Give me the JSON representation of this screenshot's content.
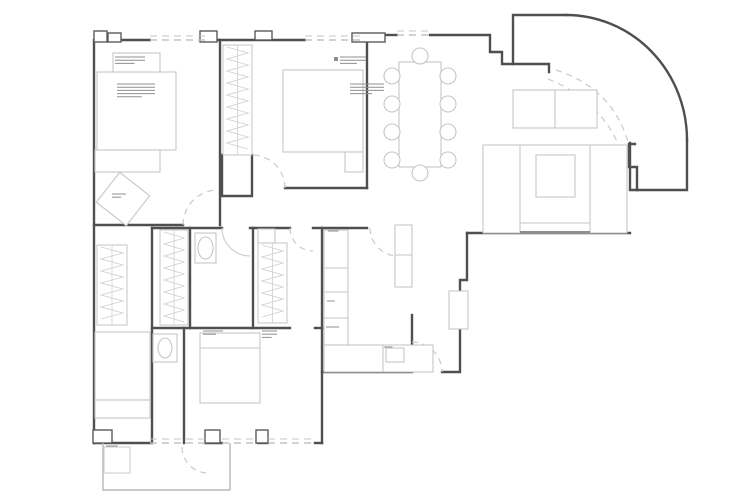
{
  "document": {
    "kind": "architectural-floor-plan",
    "canvas": {
      "width": 750,
      "height": 500
    }
  },
  "colors": {
    "background": "#ffffff",
    "wall": "#4f4f4f",
    "pier": "#5a5a5a",
    "furniture": "#c6c6c6",
    "furniture_dark": "#8e8e8e",
    "window_dash": "#c4c4c4",
    "door_dash": "#c9c9c9",
    "door_solid": "#d2d2d2",
    "zigzag": "#d0d0d0",
    "note": "#8f8f8f",
    "terrace": "#b8b8b8"
  },
  "plan": {
    "walls": [
      {
        "name": "wall-left-exterior",
        "d": "M94,443 L94,40 L150,40"
      },
      {
        "name": "wall-top-bedroom1",
        "d": "M207,40 L305,40"
      },
      {
        "name": "wall-top-bedroom2",
        "d": "M362,40 L367,40 L367,188"
      },
      {
        "name": "wall-bedroom2-bottom",
        "d": "M285,188 L367,188"
      },
      {
        "name": "wall-partition-b1-b2",
        "d": "M220,40 L220,225"
      },
      {
        "name": "wall-bedroom1-bottom",
        "d": "M94,225 L183,225"
      },
      {
        "name": "wall-closet-niche",
        "d": "M222,155 L222,196 L252,196 L252,155"
      },
      {
        "name": "wall-corridor-band-1",
        "d": "M152,228 L222,228"
      },
      {
        "name": "wall-corridor-band-2",
        "d": "M250,228 L290,228"
      },
      {
        "name": "wall-corridor-band-3",
        "d": "M313,228 L367,228"
      },
      {
        "name": "wall-bedroomBL-right",
        "d": "M152,228 L152,443"
      },
      {
        "name": "wall-closet-bath-divider",
        "d": "M190,228 L190,328"
      },
      {
        "name": "wall-bath2-right",
        "d": "M253,228 L253,328"
      },
      {
        "name": "wall-bath1-bedroom3",
        "d": "M184,328 L184,443"
      },
      {
        "name": "wall-midband-bottom",
        "d": "M152,328 L290,328"
      },
      {
        "name": "wall-midband-bottom-2",
        "d": "M315,328 L322,328"
      },
      {
        "name": "wall-kitchen-left",
        "d": "M322,228 L322,443"
      },
      {
        "name": "wall-kitchen-bottom",
        "d": "M322,372 L410,372"
      },
      {
        "name": "wall-kitchen-door-jamb",
        "d": "M412,315 L412,372"
      },
      {
        "name": "wall-hall-entry",
        "d": "M442,372 L460,372 L460,280 L467,280 L467,233"
      },
      {
        "name": "wall-living-bottom",
        "d": "M467,233 L630,233"
      },
      {
        "name": "wall-living-right",
        "d": "M630,143 L630,190 L637,190"
      },
      {
        "name": "wall-balcony-bottom",
        "d": "M637,190 L687,190 L687,140"
      },
      {
        "name": "wall-balcony-notch",
        "d": "M637,190 L637,167 L629,167 L629,144 L635,144"
      },
      {
        "name": "wall-dining-top-1",
        "d": "M385,35 L397,35"
      },
      {
        "name": "wall-dining-top-2",
        "d": "M430,35 L490,35 L490,52 L502,52 L502,64 L513,64 L513,15 L566,15"
      },
      {
        "name": "wall-balcony-curve",
        "d": "M566,15 A121,125 0 0 1 687,140"
      },
      {
        "name": "wall-balcony-inner",
        "d": "M513,64 L549,64 L549,72"
      },
      {
        "name": "wall-bottom-1",
        "d": "M94,443 L150,443"
      },
      {
        "name": "wall-bottom-2",
        "d": "M205,443 L222,443"
      },
      {
        "name": "wall-bottom-3",
        "d": "M258,443 L268,443"
      },
      {
        "name": "wall-bottom-4",
        "d": "M315,443 L322,443"
      }
    ],
    "piers": [
      {
        "name": "pier-top-corner",
        "x": 94,
        "y": 31,
        "w": 13,
        "h": 11
      },
      {
        "name": "pier-top-a",
        "x": 108,
        "y": 33,
        "w": 13,
        "h": 9
      },
      {
        "name": "pier-top-b",
        "x": 200,
        "y": 31,
        "w": 17,
        "h": 11
      },
      {
        "name": "pier-top-c",
        "x": 255,
        "y": 31,
        "w": 17,
        "h": 9
      },
      {
        "name": "pier-dining",
        "x": 352,
        "y": 33,
        "w": 33,
        "h": 9
      },
      {
        "name": "pier-bottom-a",
        "x": 93,
        "y": 430,
        "w": 19,
        "h": 13
      },
      {
        "name": "pier-bottom-b",
        "x": 205,
        "y": 430,
        "w": 15,
        "h": 13
      },
      {
        "name": "pier-bottom-c",
        "x": 256,
        "y": 430,
        "w": 12,
        "h": 13
      }
    ],
    "windows": [
      {
        "name": "window-bedroom1-top",
        "x1": 150,
        "y1": 40,
        "x2": 207,
        "y2": 40
      },
      {
        "name": "window-bedroom2-top",
        "x1": 305,
        "y1": 40,
        "x2": 362,
        "y2": 40
      },
      {
        "name": "window-dining-top",
        "x1": 397,
        "y1": 35,
        "x2": 430,
        "y2": 35
      },
      {
        "name": "window-bottom-left",
        "x1": 150,
        "y1": 443,
        "x2": 205,
        "y2": 443
      },
      {
        "name": "window-bottom-mid",
        "x1": 222,
        "y1": 443,
        "x2": 258,
        "y2": 443
      },
      {
        "name": "window-bedroom3-bottom",
        "x1": 268,
        "y1": 443,
        "x2": 315,
        "y2": 443
      }
    ],
    "doors": [
      {
        "name": "door-swing-bedroom1",
        "d": "M183,225 A35,35 0 0 1 218,190",
        "style": "dashed"
      },
      {
        "name": "door-swing-bedroom2",
        "d": "M285,188 A33,33 0 0 0 252,155",
        "style": "dashed"
      },
      {
        "name": "door-swing-bathroom",
        "d": "M222,228 A28,28 0 0 0 250,256",
        "style": "solid"
      },
      {
        "name": "door-swing-bedroom3",
        "d": "M290,228 A23,23 0 0 0 313,251",
        "style": "dashed"
      },
      {
        "name": "door-swing-kitchen",
        "d": "M412,342 A30,30 0 0 1 442,372",
        "style": "dashed"
      },
      {
        "name": "door-swing-kitchen-top",
        "d": "M370,228 A28,28 0 0 0 398,256",
        "style": "dashed"
      },
      {
        "name": "door-swing-balcony-outer",
        "d": "M556,70 Q612,88 628,142",
        "style": "dashed"
      },
      {
        "name": "door-swing-balcony-inner",
        "d": "M548,79 Q600,100 620,148",
        "style": "dashed"
      },
      {
        "name": "door-swing-terrace",
        "d": "M182,447 A26,26 0 0 0 208,473",
        "style": "dashed"
      }
    ],
    "furniture": [
      {
        "name": "bed-master",
        "type": "rect",
        "x": 97,
        "y": 72,
        "w": 79,
        "h": 78
      },
      {
        "name": "bench-master",
        "type": "rect",
        "x": 95,
        "y": 150,
        "w": 65,
        "h": 22
      },
      {
        "name": "nightstand-master",
        "type": "rect",
        "x": 113,
        "y": 53,
        "w": 47,
        "h": 19
      },
      {
        "name": "desk-rotated",
        "type": "rotrect",
        "x": 104,
        "y": 180,
        "w": 38,
        "h": 38,
        "angle": 38
      },
      {
        "name": "wardrobe-bedroom2",
        "type": "zigzag",
        "x": 223,
        "y": 45,
        "w": 29,
        "h": 110
      },
      {
        "name": "bed-bedroom2",
        "type": "rect",
        "x": 283,
        "y": 70,
        "w": 80,
        "h": 82
      },
      {
        "name": "nightstand-bedroom2",
        "type": "rect",
        "x": 345,
        "y": 152,
        "w": 18,
        "h": 20
      },
      {
        "name": "dining-table",
        "type": "rect",
        "x": 399,
        "y": 62,
        "w": 42,
        "h": 105
      },
      {
        "name": "dining-chair",
        "type": "circle",
        "cx": 392,
        "cy": 76,
        "r": 8
      },
      {
        "name": "dining-chair",
        "type": "circle",
        "cx": 392,
        "cy": 104,
        "r": 8
      },
      {
        "name": "dining-chair",
        "type": "circle",
        "cx": 392,
        "cy": 132,
        "r": 8
      },
      {
        "name": "dining-chair",
        "type": "circle",
        "cx": 392,
        "cy": 160,
        "r": 8
      },
      {
        "name": "dining-chair",
        "type": "circle",
        "cx": 448,
        "cy": 76,
        "r": 8
      },
      {
        "name": "dining-chair",
        "type": "circle",
        "cx": 448,
        "cy": 104,
        "r": 8
      },
      {
        "name": "dining-chair",
        "type": "circle",
        "cx": 448,
        "cy": 132,
        "r": 8
      },
      {
        "name": "dining-chair",
        "type": "circle",
        "cx": 448,
        "cy": 160,
        "r": 8
      },
      {
        "name": "dining-chair",
        "type": "circle",
        "cx": 420,
        "cy": 56,
        "r": 8
      },
      {
        "name": "dining-chair",
        "type": "circle",
        "cx": 420,
        "cy": 173,
        "r": 8
      },
      {
        "name": "sofa-bench",
        "type": "rect",
        "x": 513,
        "y": 90,
        "w": 84,
        "h": 38
      },
      {
        "name": "sofa-bench-divider",
        "type": "line",
        "x1": 555,
        "y1": 90,
        "x2": 555,
        "y2": 128
      },
      {
        "name": "sofa-u-outline",
        "type": "rect",
        "x": 483,
        "y": 145,
        "w": 144,
        "h": 88
      },
      {
        "name": "sofa-u-left",
        "type": "line",
        "x1": 520,
        "y1": 145,
        "x2": 520,
        "y2": 233
      },
      {
        "name": "sofa-u-right",
        "type": "line",
        "x1": 590,
        "y1": 145,
        "x2": 590,
        "y2": 233
      },
      {
        "name": "sofa-u-seat",
        "type": "line",
        "x1": 520,
        "y1": 223,
        "x2": 590,
        "y2": 223
      },
      {
        "name": "sofa-u-back",
        "type": "line",
        "x1": 520,
        "y1": 232,
        "x2": 590,
        "y2": 232,
        "stroke": "#8e8e8e",
        "width": 2
      },
      {
        "name": "coffee-table",
        "type": "rect",
        "x": 536,
        "y": 155,
        "w": 39,
        "h": 42
      },
      {
        "name": "hall-cabinet",
        "type": "rect",
        "x": 449,
        "y": 291,
        "w": 19,
        "h": 38
      },
      {
        "name": "kitchen-counter-left",
        "type": "rect",
        "x": 324,
        "y": 230,
        "w": 24,
        "h": 115
      },
      {
        "name": "kitchen-counter-line",
        "type": "line",
        "x1": 324,
        "y1": 268,
        "x2": 348,
        "y2": 268
      },
      {
        "name": "kitchen-counter-line",
        "type": "line",
        "x1": 324,
        "y1": 292,
        "x2": 348,
        "y2": 292
      },
      {
        "name": "kitchen-counter-line",
        "type": "line",
        "x1": 324,
        "y1": 318,
        "x2": 348,
        "y2": 318
      },
      {
        "name": "kitchen-counter-bottom",
        "type": "rect",
        "x": 324,
        "y": 345,
        "w": 109,
        "h": 27
      },
      {
        "name": "kitchen-sink",
        "type": "rect",
        "x": 386,
        "y": 348,
        "w": 18,
        "h": 14
      },
      {
        "name": "kitchen-counter-line",
        "type": "line",
        "x1": 383,
        "y1": 345,
        "x2": 383,
        "y2": 372
      },
      {
        "name": "kitchen-tall-unit",
        "type": "rect",
        "x": 395,
        "y": 225,
        "w": 17,
        "h": 62
      },
      {
        "name": "kitchen-tall-line",
        "type": "line",
        "x1": 395,
        "y1": 255,
        "x2": 412,
        "y2": 255
      },
      {
        "name": "toilet-cistern",
        "type": "rect",
        "x": 195,
        "y": 233,
        "w": 21,
        "h": 30
      },
      {
        "name": "toilet-bowl",
        "type": "ellipse",
        "cx": 205.5,
        "cy": 248,
        "rx": 7.5,
        "ry": 11
      },
      {
        "name": "bath-vanity",
        "type": "rect",
        "x": 153,
        "y": 334,
        "w": 24,
        "h": 28
      },
      {
        "name": "bath-sink",
        "type": "ellipse",
        "cx": 165,
        "cy": 348,
        "rx": 7,
        "ry": 10
      },
      {
        "name": "wardrobe-left",
        "type": "zigzag",
        "x": 97,
        "y": 245,
        "w": 30,
        "h": 80
      },
      {
        "name": "wardrobe-walkin",
        "type": "zigzag",
        "x": 160,
        "y": 230,
        "w": 28,
        "h": 95
      },
      {
        "name": "wardrobe-bedroom3",
        "type": "zigzag",
        "x": 258,
        "y": 243,
        "w": 29,
        "h": 80
      },
      {
        "name": "wardrobe-box",
        "type": "rect",
        "x": 258,
        "y": 229,
        "w": 17,
        "h": 14
      },
      {
        "name": "bed-bedroom3",
        "type": "rect",
        "x": 200,
        "y": 333,
        "w": 60,
        "h": 70
      },
      {
        "name": "bed-pillow-line",
        "type": "line",
        "x1": 200,
        "y1": 348,
        "x2": 260,
        "y2": 348
      },
      {
        "name": "bed-bedroomBL",
        "type": "rect",
        "x": 95,
        "y": 332,
        "w": 55,
        "h": 68
      },
      {
        "name": "bench-bedroomBL",
        "type": "rect",
        "x": 95,
        "y": 400,
        "w": 55,
        "h": 18
      },
      {
        "name": "terrace-outline",
        "type": "path",
        "d": "M103,443 L103,490 L230,490 L230,443",
        "stroke": "#b8b8b8"
      },
      {
        "name": "terrace-step",
        "type": "rect",
        "x": 104,
        "y": 447,
        "w": 26,
        "h": 26,
        "stroke": "#cfcfcf"
      }
    ],
    "notes": [
      {
        "name": "spec-note",
        "x": 115,
        "y": 57,
        "w": 30,
        "lines": 3
      },
      {
        "name": "spec-note",
        "x": 117,
        "y": 84,
        "w": 38,
        "lines": 5
      },
      {
        "name": "spec-note",
        "x": 340,
        "y": 57,
        "w": 26,
        "lines": 3,
        "bullet": true
      },
      {
        "name": "spec-note",
        "x": 350,
        "y": 84,
        "w": 34,
        "lines": 4
      },
      {
        "name": "spec-note",
        "x": 328,
        "y": 231,
        "w": 16,
        "lines": 1
      },
      {
        "name": "spec-note",
        "x": 327,
        "y": 301,
        "w": 12,
        "lines": 1
      },
      {
        "name": "spec-note",
        "x": 326,
        "y": 327,
        "w": 20,
        "lines": 1
      },
      {
        "name": "spec-note",
        "x": 384,
        "y": 347,
        "w": 13,
        "lines": 1
      },
      {
        "name": "spec-note",
        "x": 203,
        "y": 331,
        "w": 20,
        "lines": 2
      },
      {
        "name": "spec-note",
        "x": 262,
        "y": 331,
        "w": 15,
        "lines": 3
      },
      {
        "name": "spec-note",
        "x": 112,
        "y": 194,
        "w": 14,
        "lines": 2
      },
      {
        "name": "spec-note",
        "x": 106,
        "y": 446,
        "w": 18,
        "lines": 1
      }
    ]
  }
}
